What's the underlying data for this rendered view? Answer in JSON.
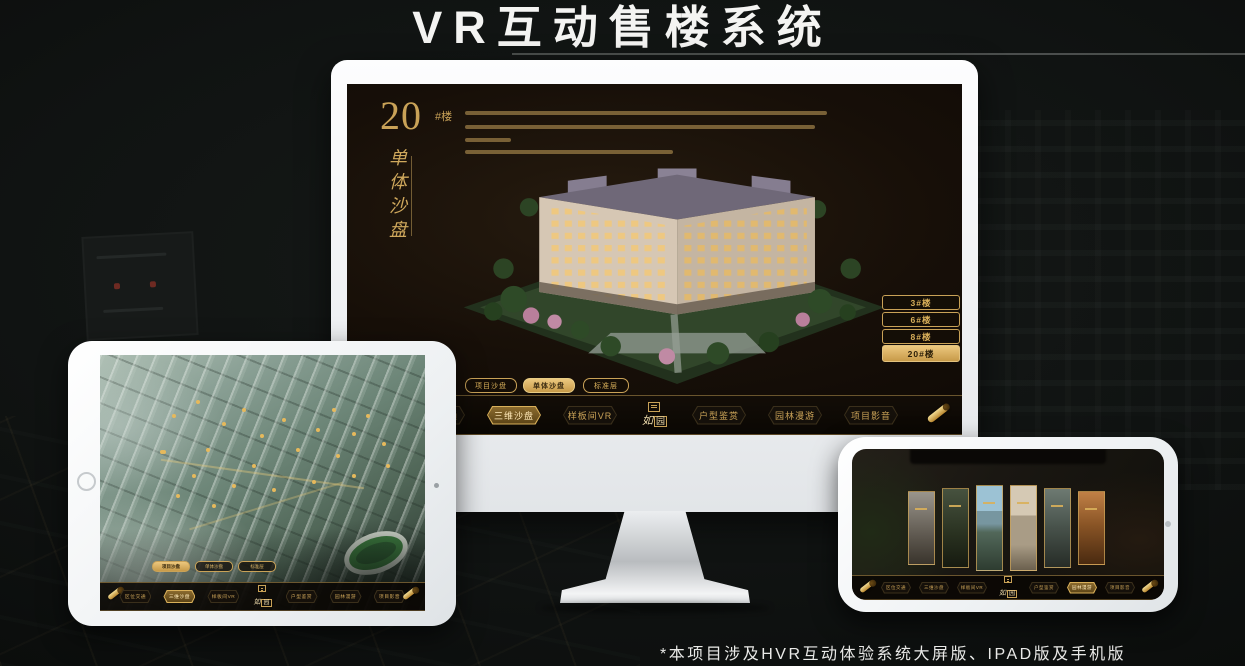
{
  "page": {
    "title": "VR互动售楼系统",
    "footnote": "*本项目涉及HVR互动体验系统大屏版、IPAD版及手机版"
  },
  "colors": {
    "gold": "#c9a257",
    "gold_bright": "#e6c078",
    "screen_bg": "#15100a"
  },
  "brand": {
    "logo_char_1": "如",
    "logo_char_2": "园"
  },
  "desktop_app": {
    "section_number": "20",
    "section_unit": "#楼",
    "section_title_vertical": "单体沙盘",
    "building_buttons": [
      {
        "label": "3#楼",
        "selected": false
      },
      {
        "label": "6#楼",
        "selected": false
      },
      {
        "label": "8#楼",
        "selected": false
      },
      {
        "label": "20#楼",
        "selected": true
      }
    ],
    "floor_tabs": [
      {
        "label": "项目沙盘",
        "selected": false
      },
      {
        "label": "单体沙盘",
        "selected": true
      },
      {
        "label": "标准层",
        "selected": false
      }
    ],
    "nav_items": [
      {
        "label": "区位交通",
        "selected": false
      },
      {
        "label": "三维沙盘",
        "selected": true
      },
      {
        "label": "样板间VR",
        "selected": false
      },
      {
        "label": "户型鉴赏",
        "selected": false
      },
      {
        "label": "园林漫游",
        "selected": false
      },
      {
        "label": "项目影音",
        "selected": false
      }
    ]
  },
  "tablet_app": {
    "floor_tabs": [
      {
        "label": "项目沙盘",
        "selected": true
      },
      {
        "label": "单体沙盘",
        "selected": false
      },
      {
        "label": "标准层",
        "selected": false
      }
    ],
    "nav_items": [
      {
        "label": "区位交通",
        "selected": false
      },
      {
        "label": "三维沙盘",
        "selected": true
      },
      {
        "label": "样板间VR",
        "selected": false
      },
      {
        "label": "户型鉴赏",
        "selected": false
      },
      {
        "label": "园林漫游",
        "selected": false
      },
      {
        "label": "项目影音",
        "selected": false
      }
    ]
  },
  "phone_app": {
    "nav_items": [
      {
        "label": "区位交通",
        "selected": false
      },
      {
        "label": "三维沙盘",
        "selected": false
      },
      {
        "label": "样板间VR",
        "selected": false
      },
      {
        "label": "户型鉴赏",
        "selected": false
      },
      {
        "label": "园林漫游",
        "selected": true
      },
      {
        "label": "项目影音",
        "selected": false
      }
    ]
  }
}
